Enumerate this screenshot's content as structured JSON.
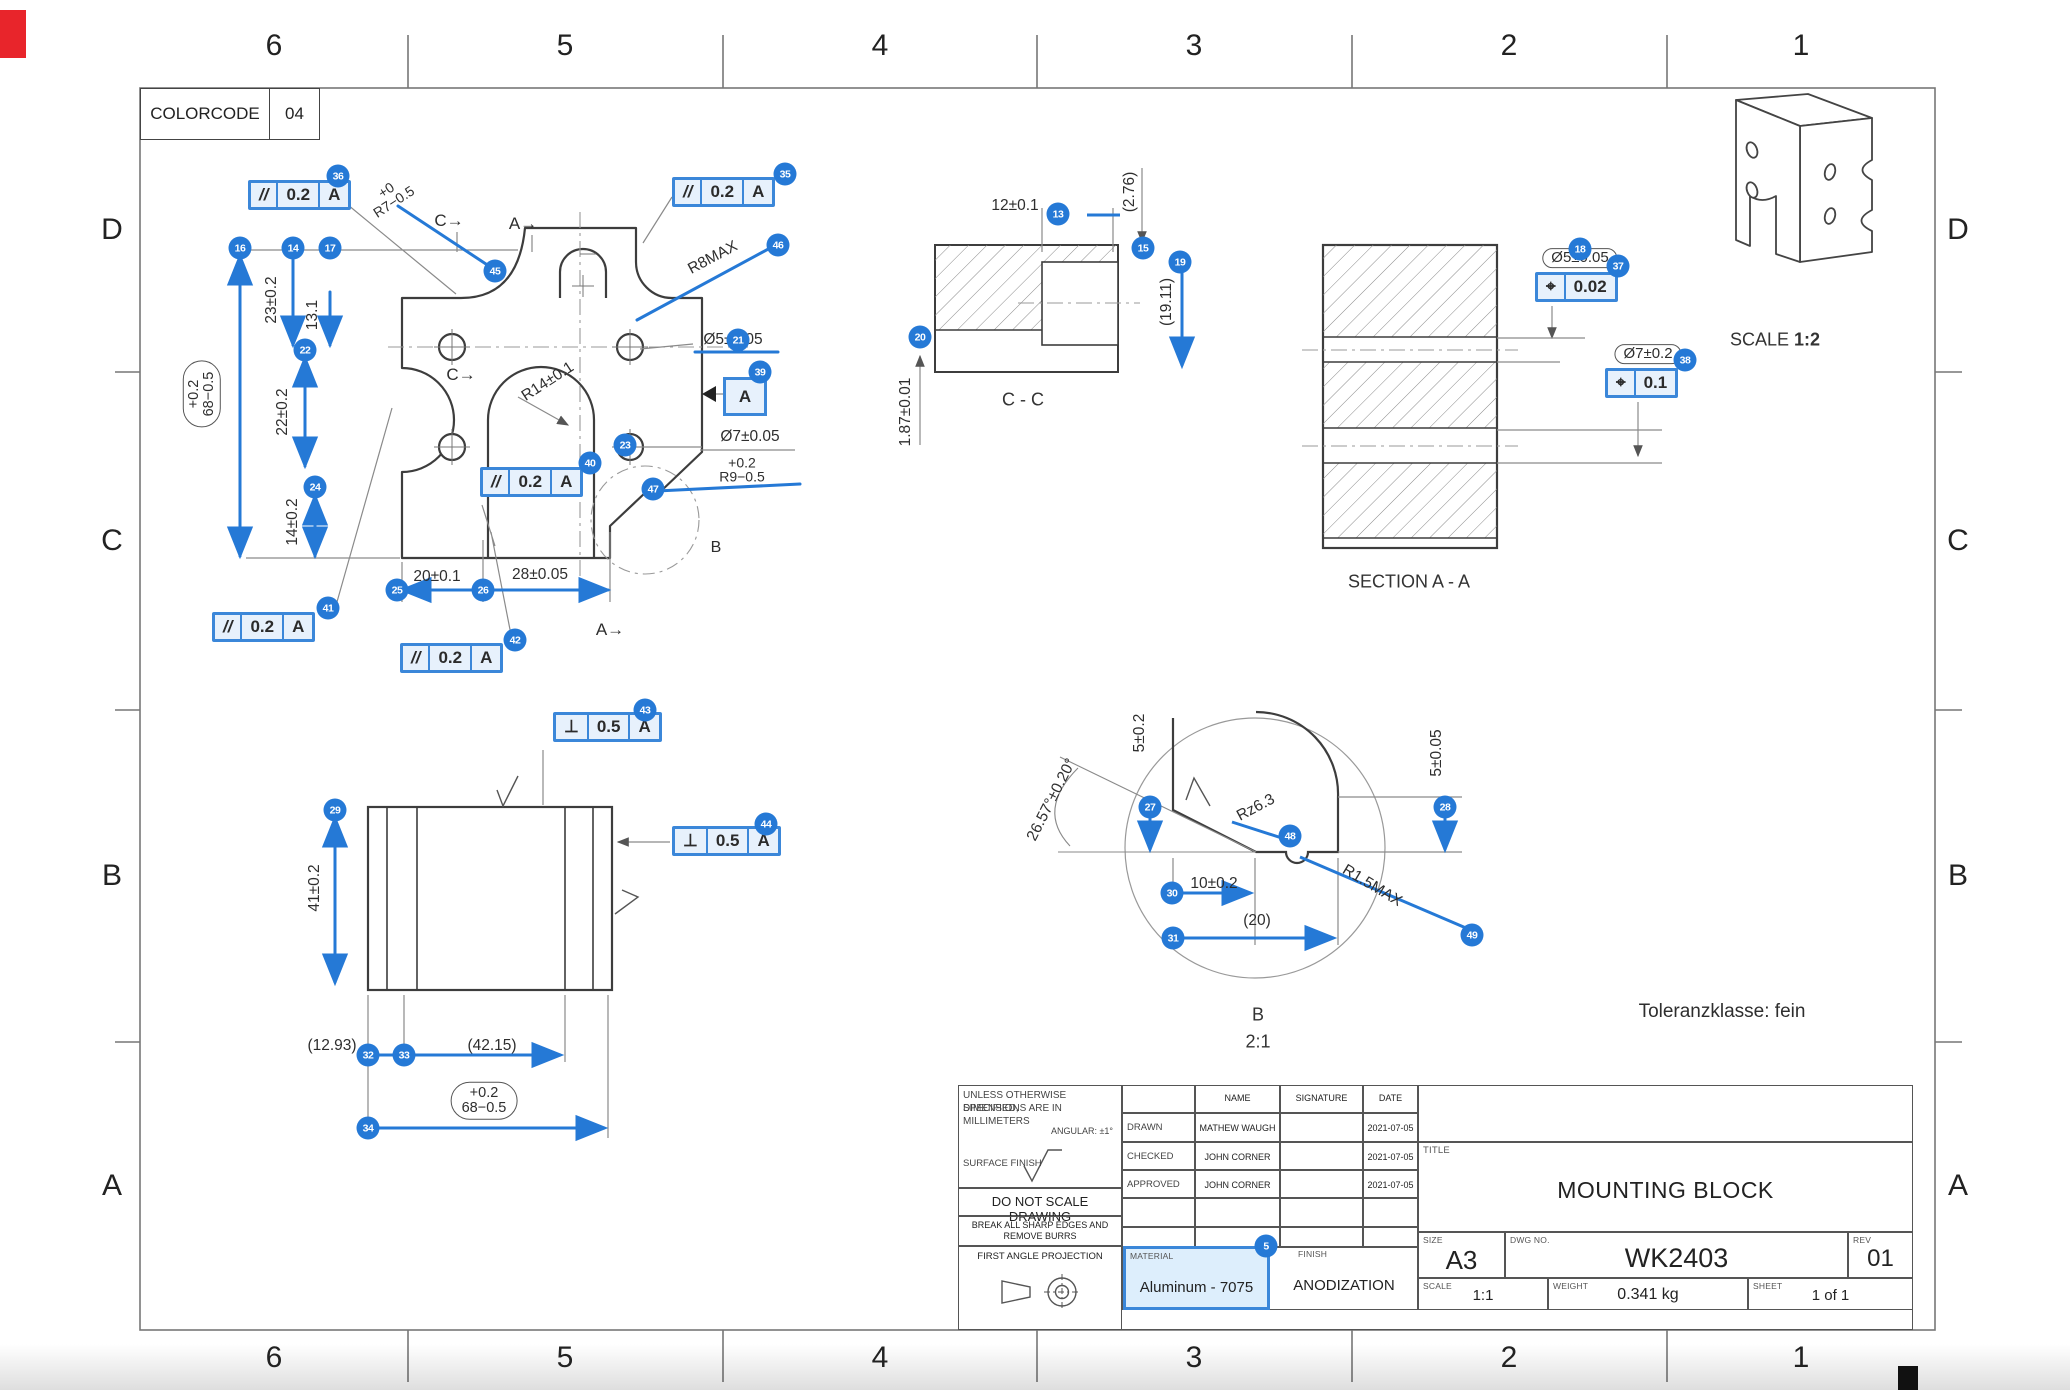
{
  "page": {
    "colorcode_label": "COLORCODE",
    "colorcode_value": "04",
    "tolerance_note": "Toleranzklasse: fein"
  },
  "colors": {
    "accent": "#2579d6",
    "fcf_fill": "#e7f1fc",
    "corner_mark": "#e8252b"
  },
  "border": {
    "cols": [
      "6",
      "5",
      "4",
      "3",
      "2",
      "1"
    ],
    "rows": [
      "D",
      "C",
      "B",
      "A"
    ]
  },
  "labels": {
    "r14": "R14±0.1",
    "angle": "26.57°±0.20°",
    "sec_cc": "C - C",
    "sec_aa": "SECTION  A - A",
    "detail_b": "B",
    "detail_scale": "2:1",
    "iso_scale_label": "SCALE",
    "iso_scale_value": "1:2",
    "sec_c_arrow": "C→",
    "sec_a_arrow": "A→",
    "detail_marker_b": "B"
  },
  "callouts": {
    "5": {
      "n": "5",
      "text": "Aluminum - 7075"
    },
    "13": {
      "n": "13",
      "text": "12±0.1"
    },
    "14": {
      "n": "14",
      "text": "23±0.2"
    },
    "15": {
      "n": "15",
      "text": "(2.76)"
    },
    "16": {
      "n": "16",
      "line1": "+0.2",
      "line2": "68−0.5"
    },
    "17": {
      "n": "17",
      "text": "13.1"
    },
    "18": {
      "n": "18",
      "text": "Ø5±0.05"
    },
    "19": {
      "n": "19",
      "text": "(19.11)"
    },
    "20": {
      "n": "20",
      "text": "1.87±0.01"
    },
    "21": {
      "n": "21",
      "text": "Ø5±0.05"
    },
    "22": {
      "n": "22",
      "text": "22±0.2"
    },
    "23": {
      "n": "23",
      "text": "Ø7±0.05"
    },
    "24": {
      "n": "24",
      "text": "14±0.2"
    },
    "25": {
      "n": "25",
      "text": "20±0.1"
    },
    "26": {
      "n": "26",
      "text": "28±0.05"
    },
    "27": {
      "n": "27",
      "text": "5±0.2"
    },
    "28": {
      "n": "28",
      "text": "5±0.05"
    },
    "29": {
      "n": "29",
      "text": "41±0.2"
    },
    "30": {
      "n": "30",
      "text": "10±0.2"
    },
    "31": {
      "n": "31",
      "text": "(20)"
    },
    "32": {
      "n": "32",
      "text": "(12.93)"
    },
    "33": {
      "n": "33",
      "text": "(42.15)"
    },
    "34": {
      "n": "34",
      "line1": "+0.2",
      "line2": "68−0.5"
    },
    "35": {
      "n": "35",
      "sym": "//",
      "tol": "0.2",
      "datum": "A"
    },
    "36": {
      "n": "36",
      "sym": "//",
      "tol": "0.2",
      "datum": "A"
    },
    "37": {
      "n": "37",
      "sym": "⌖",
      "tol": "0.02"
    },
    "38": {
      "n": "38",
      "text": "Ø7±0.2",
      "sym": "⌖",
      "tol": "0.1"
    },
    "39": {
      "n": "39",
      "datum": "A"
    },
    "40": {
      "n": "40",
      "sym": "//",
      "tol": "0.2",
      "datum": "A"
    },
    "41": {
      "n": "41",
      "sym": "//",
      "tol": "0.2",
      "datum": "A"
    },
    "42": {
      "n": "42",
      "sym": "//",
      "tol": "0.2",
      "datum": "A"
    },
    "43": {
      "n": "43",
      "sym": "⊥",
      "tol": "0.5",
      "datum": "A"
    },
    "44": {
      "n": "44",
      "sym": "⊥",
      "tol": "0.5",
      "datum": "A"
    },
    "45": {
      "n": "45",
      "line1": "+0",
      "line2": "R7−0.5"
    },
    "46": {
      "n": "46",
      "text": "R8MAX"
    },
    "47": {
      "n": "47",
      "line1": "+0.2",
      "line2": "R9−0.5"
    },
    "48": {
      "n": "48",
      "text": "Rz6.3"
    },
    "49": {
      "n": "49",
      "text": "R1.5MAX"
    }
  },
  "title_block": {
    "notes_line1": "UNLESS OTHERWISE SPECIFIED,",
    "notes_line2": "DIMENSIONS ARE IN MILLIMETERS",
    "angular": "ANGULAR: ±1°",
    "surface_finish_label": "SURFACE FINISH",
    "do_not_scale": "DO NOT SCALE DRAWING",
    "break_edges_1": "BREAK ALL SHARP EDGES AND",
    "break_edges_2": "REMOVE BURRS",
    "projection": "FIRST ANGLE PROJECTION",
    "col_name": "NAME",
    "col_signature": "SIGNATURE",
    "col_date": "DATE",
    "rows": [
      {
        "role": "DRAWN",
        "name": "MATHEW WAUGH",
        "date": "2021-07-05"
      },
      {
        "role": "CHECKED",
        "name": "JOHN CORNER",
        "date": "2021-07-05"
      },
      {
        "role": "APPROVED",
        "name": "JOHN CORNER",
        "date": "2021-07-05"
      }
    ],
    "material_label": "MATERIAL",
    "material_value": "Aluminum - 7075",
    "finish_label": "FINISH",
    "finish_value": "ANODIZATION",
    "title_label": "TITLE",
    "title_value": "MOUNTING BLOCK",
    "size_label": "SIZE",
    "size_value": "A3",
    "dwg_label": "DWG NO.",
    "dwg_value": "WK2403",
    "rev_label": "REV",
    "rev_value": "01",
    "scale_label": "SCALE",
    "scale_value": "1:1",
    "weight_label": "WEIGHT",
    "weight_value": "0.341 kg",
    "sheet_label": "SHEET",
    "sheet_value": "1 of 1"
  }
}
